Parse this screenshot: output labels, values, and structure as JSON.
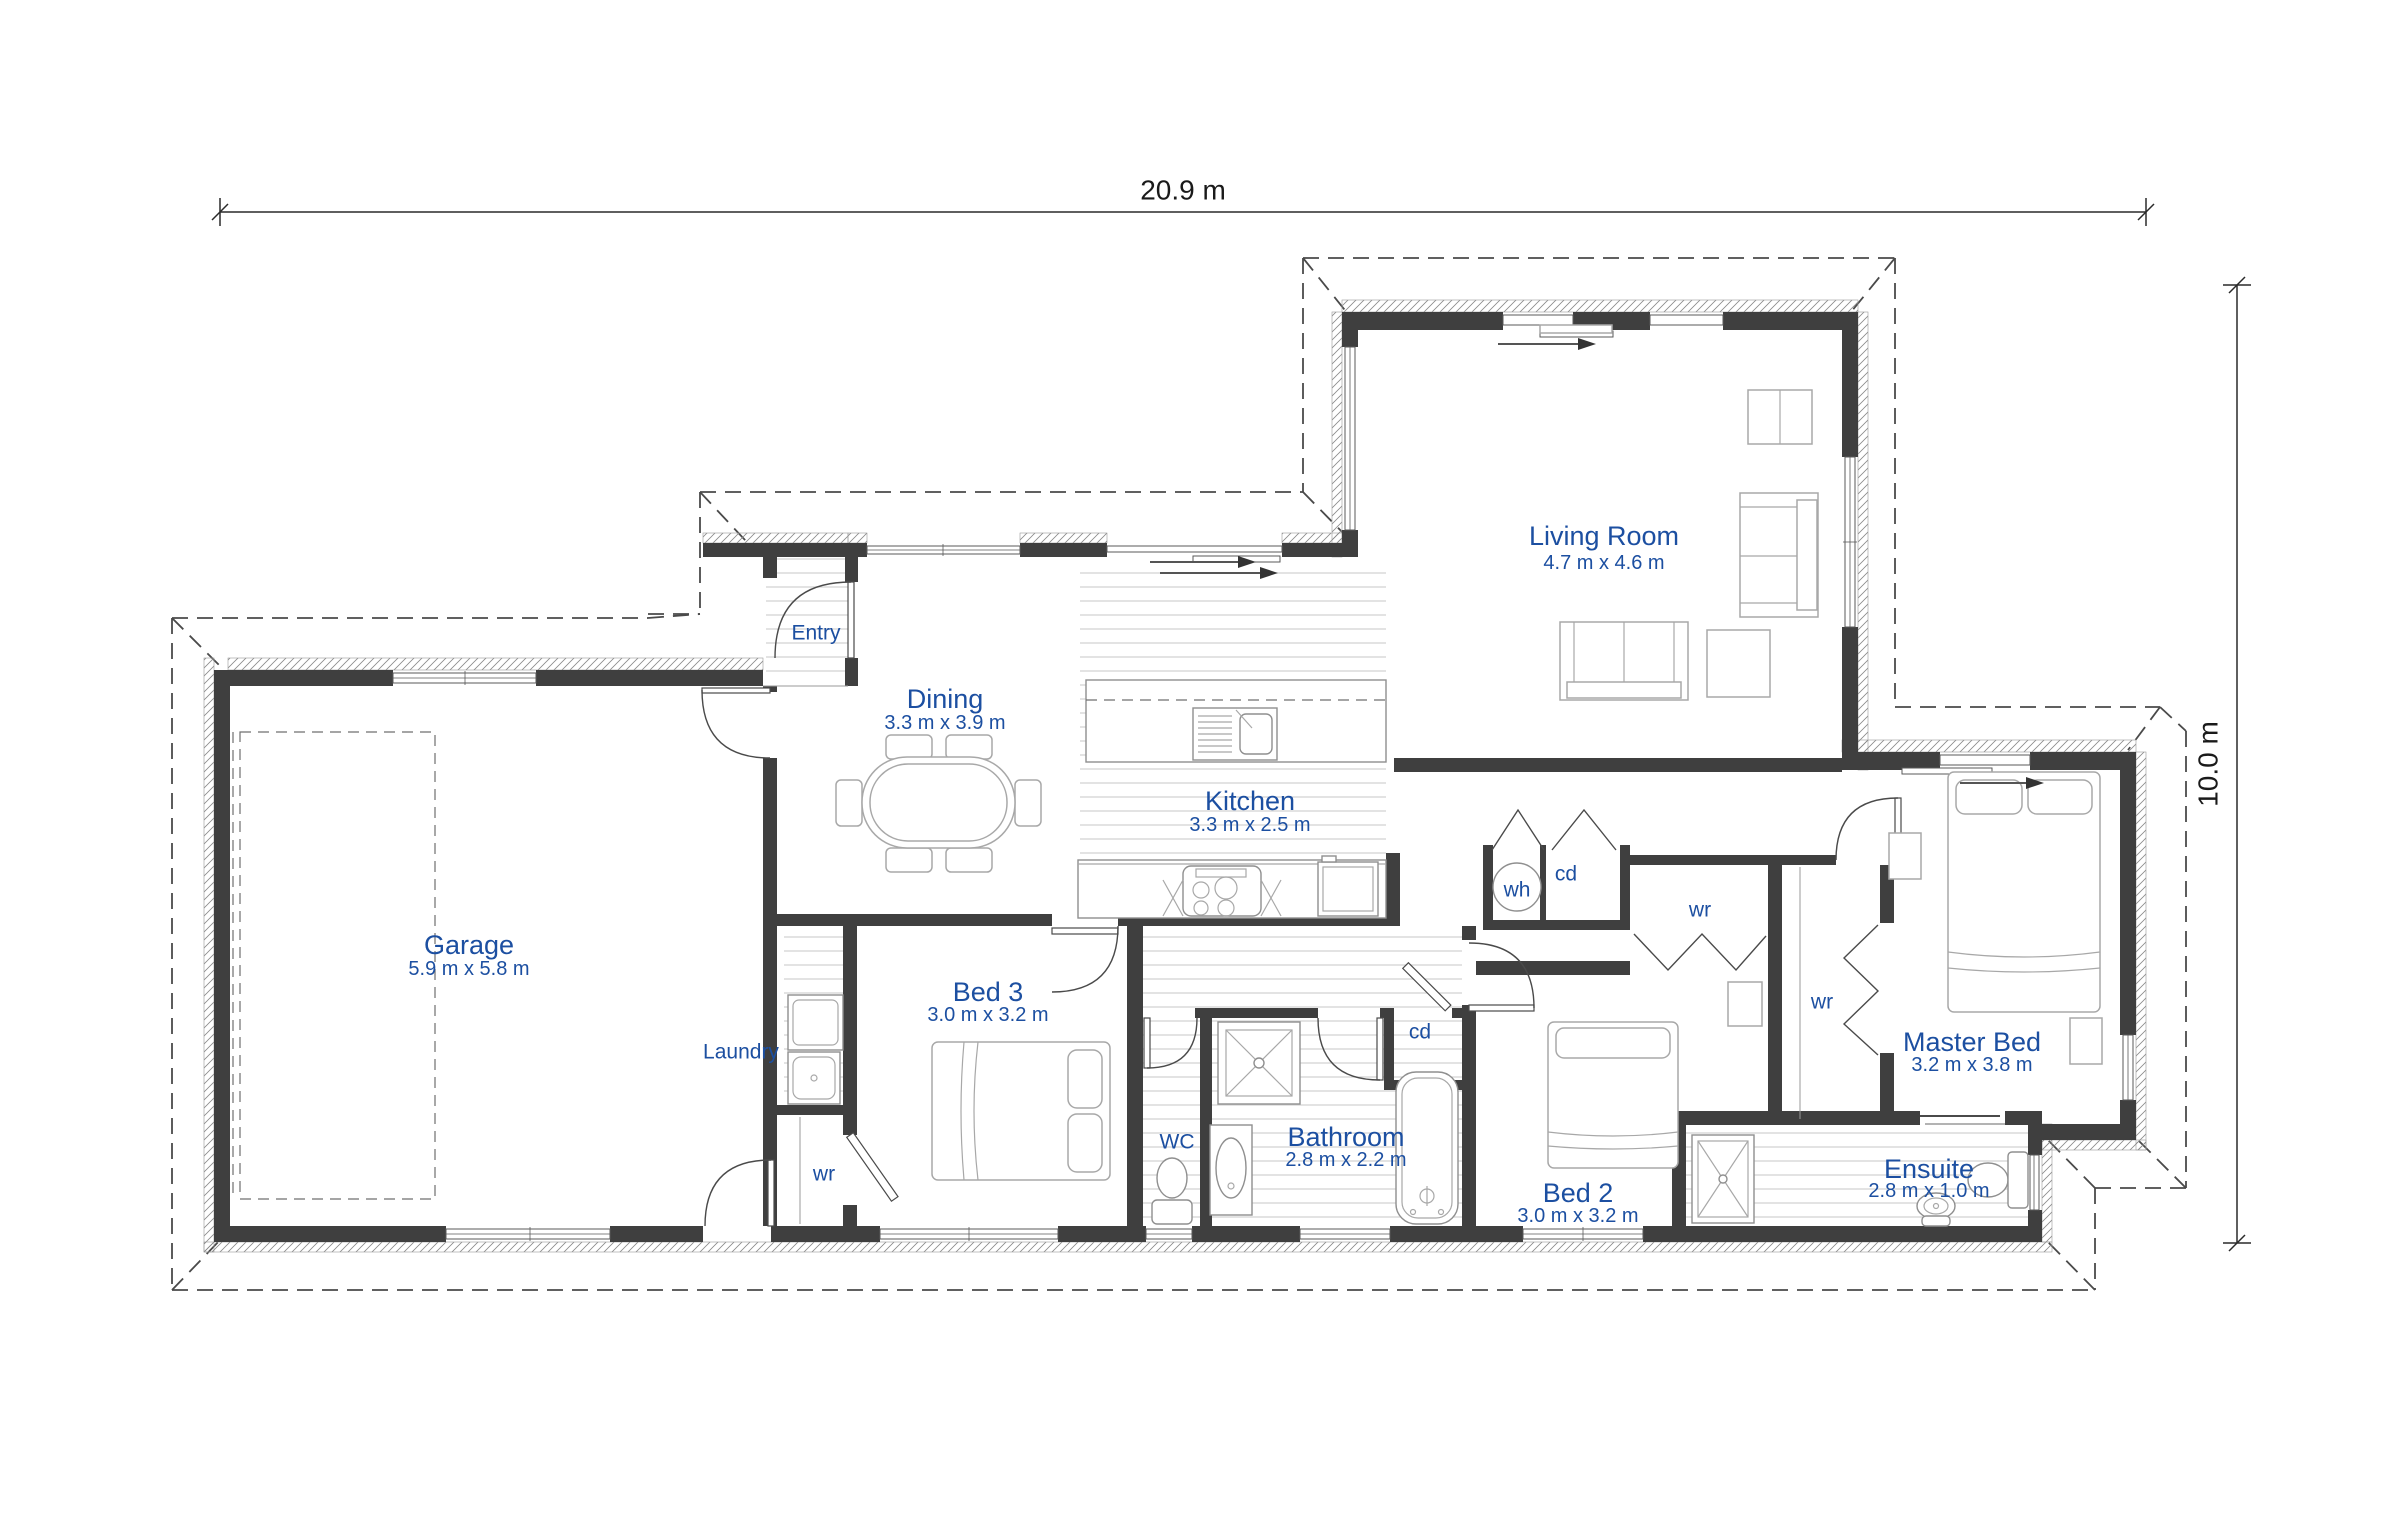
{
  "plan": {
    "dim_width": "20.9 m",
    "dim_height": "10.0 m",
    "rooms": [
      {
        "name": "Living Room",
        "dims": "4.7 m x 4.6 m"
      },
      {
        "name": "Dining",
        "dims": "3.3 m x 3.9 m"
      },
      {
        "name": "Kitchen",
        "dims": "3.3 m x 2.5 m"
      },
      {
        "name": "Garage",
        "dims": "5.9 m x 5.8 m"
      },
      {
        "name": "Bed 3",
        "dims": "3.0 m x 3.2 m"
      },
      {
        "name": "Bathroom",
        "dims": "2.8 m x 2.2 m"
      },
      {
        "name": "Bed 2",
        "dims": "3.0 m x 3.2 m"
      },
      {
        "name": "Master Bed",
        "dims": "3.2 m x 3.8 m"
      },
      {
        "name": "Ensuite",
        "dims": "2.8 m x 1.0 m"
      }
    ],
    "labels": {
      "entry": "Entry",
      "laundry": "Laundry",
      "wc": "WC",
      "wh": "wh",
      "cd": "cd",
      "wr": "wr"
    },
    "colors": {
      "label_blue": "#1c4fa1",
      "wall_dark": "#3f3f3f",
      "dim_text": "#1a1a1a"
    }
  }
}
